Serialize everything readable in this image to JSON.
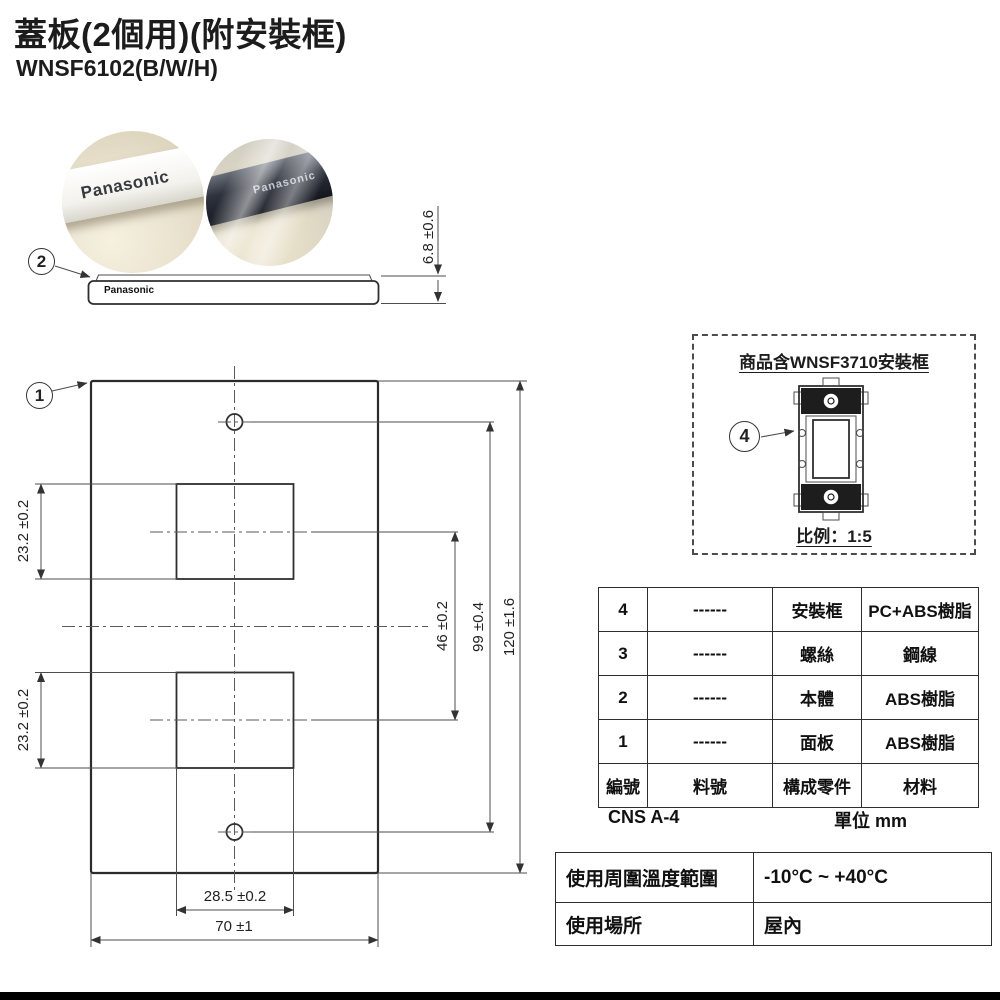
{
  "header": {
    "title": "蓋板(2個用)(附安裝框)",
    "model": "WNSF6102(B/W/H)"
  },
  "photos": {
    "left_brand": "Panasonic",
    "right_brand": "Panasonic"
  },
  "side_view": {
    "balloon": "2",
    "brand": "Panasonic",
    "thickness_dim": "6.8 ±0.6"
  },
  "front_view": {
    "balloon": "1",
    "dims": {
      "cutout_height_top": "23.2 ±0.2",
      "cutout_height_bottom": "23.2 ±0.2",
      "cutout_center_gap": "46 ±0.2",
      "screw_hole_span": "99 ±0.4",
      "plate_height": "120 ±1.6",
      "cutout_width": "28.5 ±0.2",
      "plate_width": "70 ±1"
    }
  },
  "frame_box": {
    "title": "商品含WNSF3710安裝框",
    "balloon": "4",
    "scale": "比例：1:5"
  },
  "parts_table": {
    "rows": [
      [
        "4",
        "------",
        "安裝框",
        "PC+ABS樹脂"
      ],
      [
        "3",
        "------",
        "螺絲",
        "鋼線"
      ],
      [
        "2",
        "------",
        "本體",
        "ABS樹脂"
      ],
      [
        "1",
        "------",
        "面板",
        "ABS樹脂"
      ]
    ],
    "header_row": [
      "編號",
      "料號",
      "構成零件",
      "材料"
    ],
    "standard": "CNS A-4",
    "unit": "單位 mm"
  },
  "usage_table": {
    "rows": [
      {
        "label": "使用周圍溫度範圍",
        "value": "-10°C ~ +40°C"
      },
      {
        "label": "使用場所",
        "value": "屋內"
      }
    ]
  },
  "colors": {
    "line": "#2f2f2f",
    "accent_dark": "#1a1a1a",
    "background": "#ffffff"
  }
}
